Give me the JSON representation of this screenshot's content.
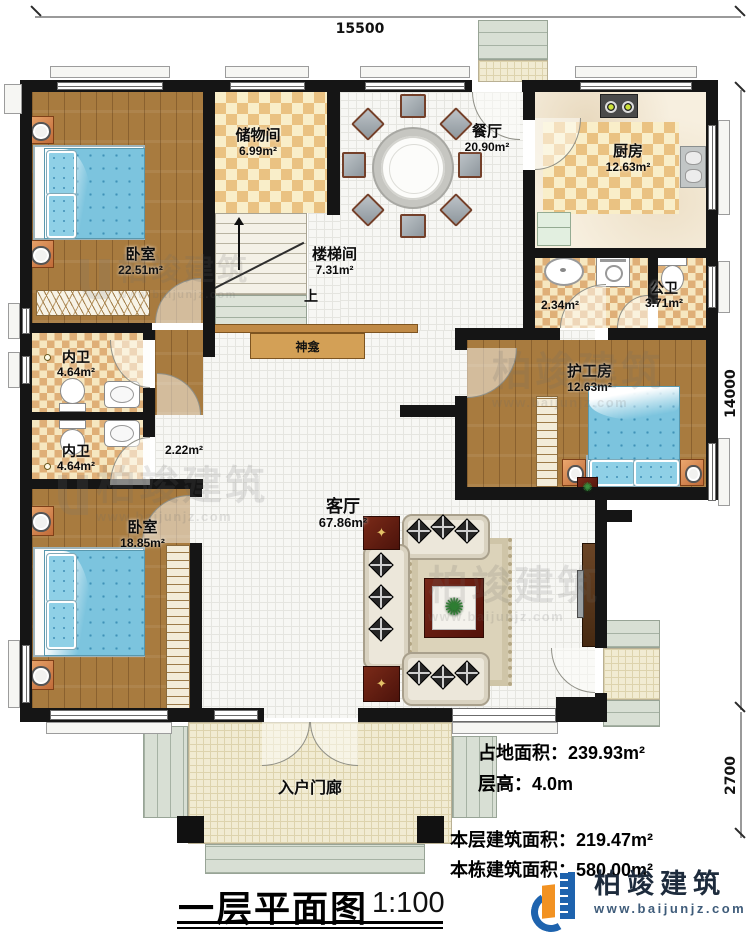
{
  "dimensions": {
    "width_top": "15500",
    "height_main": "14000",
    "height_porch": "2700"
  },
  "rooms": {
    "bedroom1": {
      "name": "卧室",
      "area": "22.51m²"
    },
    "storage": {
      "name": "储物间",
      "area": "6.99m²"
    },
    "stairwell": {
      "name": "楼梯间",
      "area": "7.31m²",
      "up": "上"
    },
    "dining": {
      "name": "餐厅",
      "area": "20.90m²"
    },
    "kitchen": {
      "name": "厨房",
      "area": "12.63m²"
    },
    "public_bath": {
      "name": "公卫",
      "area": "3.71m²"
    },
    "wash_area": {
      "area": "2.34m²"
    },
    "inner_bath1": {
      "name": "内卫",
      "area": "4.64m²"
    },
    "inner_bath2": {
      "name": "内卫",
      "area": "4.64m²"
    },
    "hallway": {
      "area": "2.22m²"
    },
    "bedroom2": {
      "name": "卧室",
      "area": "18.85m²"
    },
    "caregiver": {
      "name": "护工房",
      "area": "12.63m²"
    },
    "living": {
      "name": "客厅",
      "area": "67.86m²"
    },
    "porch": {
      "name": "入户门廊"
    },
    "shrine": {
      "name": "神龛"
    }
  },
  "stats": {
    "land_area": {
      "label": "占地面积：",
      "value": "239.93m²"
    },
    "floor_height": {
      "label": "层高：",
      "value": "4.0m"
    },
    "floor_area": {
      "label": "本层建筑面积：",
      "value": "219.47m²"
    },
    "total_area": {
      "label": "本栋建筑面积：",
      "value": "580.00m²"
    }
  },
  "title": {
    "name": "一层平面图",
    "scale": "1:100"
  },
  "branding": {
    "company": "柏竣建筑",
    "website": "www.baijunjz.com"
  },
  "watermark": {
    "text": "柏竣建筑",
    "website": "www.baijunjz.com"
  },
  "icons": {
    "table_star": "✦",
    "plant": "✺"
  }
}
